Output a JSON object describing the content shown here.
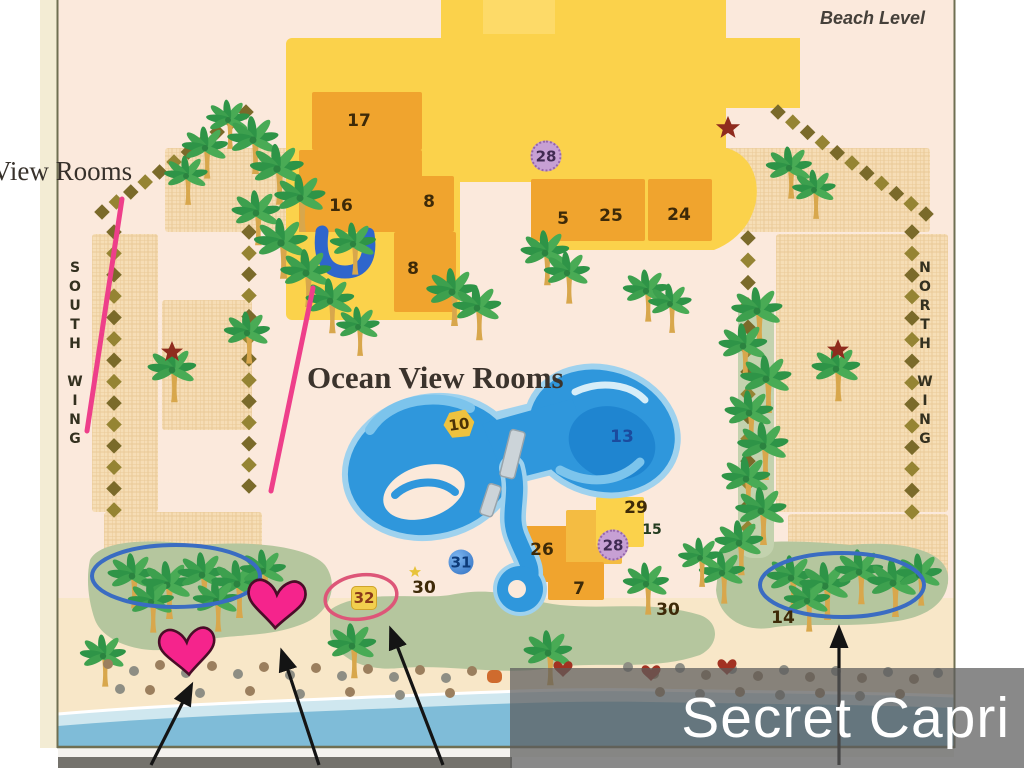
{
  "slide": {
    "caption": "Secret Capri"
  },
  "map": {
    "level_label": "Beach Level",
    "left_partial_label": "View Rooms",
    "south_wing_label": "SOUTH WING",
    "north_wing_label": "NORTH WING",
    "ocean_view_label": "Ocean View Rooms",
    "numbers": {
      "n17": "17",
      "n16": "16",
      "n8a": "8",
      "n8b": "8",
      "n28top": "28",
      "n5": "5",
      "n25": "25",
      "n24": "24",
      "n10": "10",
      "n13": "13",
      "n29": "29",
      "n15": "15",
      "n26": "26",
      "n28bottom": "28",
      "n7": "7",
      "n31": "31",
      "n30left": "30",
      "n32": "32",
      "n30right": "30",
      "n14": "14"
    },
    "colors": {
      "building_light": "#FBD24B",
      "building_dark": "#F0A42E",
      "pool_blue": "#2F97DC",
      "lawn_green": "#B5C69E",
      "heart_pink": "#F5248C",
      "annotation_blue": "#3A6CC2",
      "annotation_red": "#DD5678",
      "caption_background": "rgba(92,92,92,0.72)"
    }
  }
}
